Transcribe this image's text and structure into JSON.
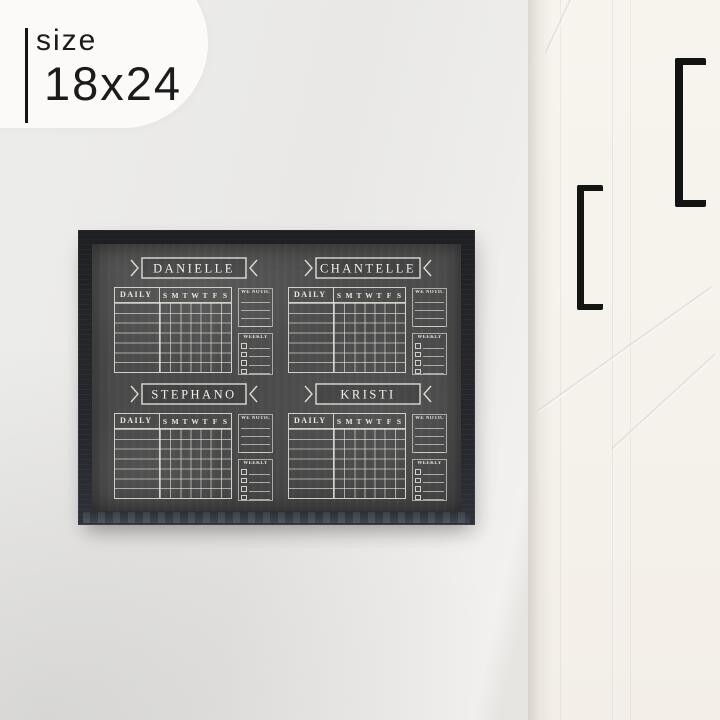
{
  "size_badge": {
    "label": "size",
    "value": "18x24"
  },
  "board": {
    "frame_color": "#232529",
    "surface_color": "#4a4a4a",
    "chalk_color": "#e9e6de",
    "daily_label": "DAILY",
    "days": [
      "S",
      "M",
      "T",
      "W",
      "T",
      "F",
      "S"
    ],
    "we_noticed_label": "WE NOTICED...",
    "weekly_label": "WEEKLY",
    "rows_per_chart": 7,
    "noticed_line_count": 4,
    "weekly_checkbox_count": 4,
    "quadrants": [
      {
        "name": "DANIELLE"
      },
      {
        "name": "CHANTELLE"
      },
      {
        "name": "STEPHANO"
      },
      {
        "name": "KRISTI"
      }
    ]
  },
  "scene": {
    "wall_color": "#e9e8e6",
    "cabinet_color": "#f5f2eb",
    "handle_color": "#141414",
    "handle_count": 2
  }
}
